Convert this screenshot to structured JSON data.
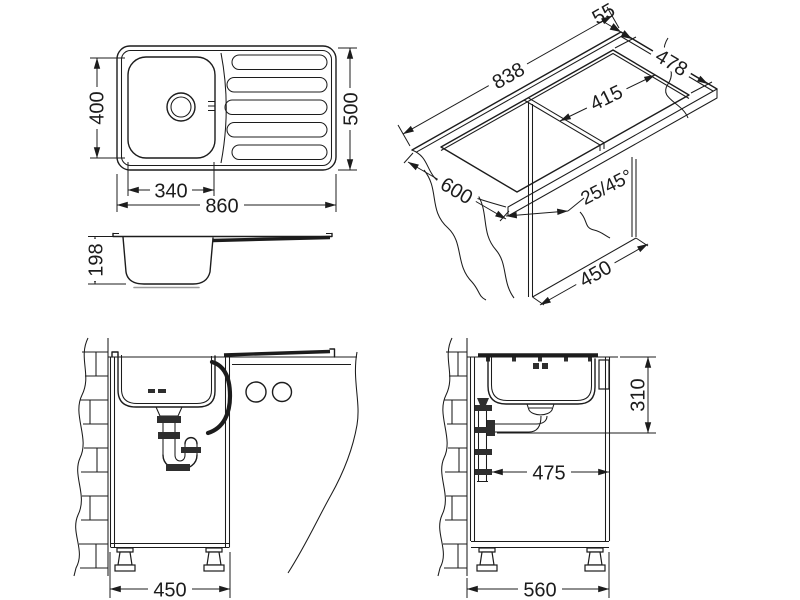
{
  "drawing": {
    "title": "kitchen sink technical installation drawing",
    "line_color": "#1c1c1c",
    "background": "#ffffff",
    "views": {
      "top_view": {
        "overall_length": "860",
        "overall_width": "500",
        "bowl_width": "340",
        "bowl_depth": "400"
      },
      "profile_view": {
        "bowl_height": "198"
      },
      "iso_view": {
        "cutout_length": "838",
        "edge_clearance": "55",
        "cutout_width": "478",
        "drainer_cutout_length": "415",
        "worktop_depth": "600",
        "edge_chamfer": "25/45°",
        "cabinet_width": "450"
      },
      "front_install_view": {
        "cabinet_width": "450"
      },
      "side_install_view": {
        "drain_height": "310",
        "drain_offset": "475",
        "cabinet_depth": "560"
      }
    }
  }
}
